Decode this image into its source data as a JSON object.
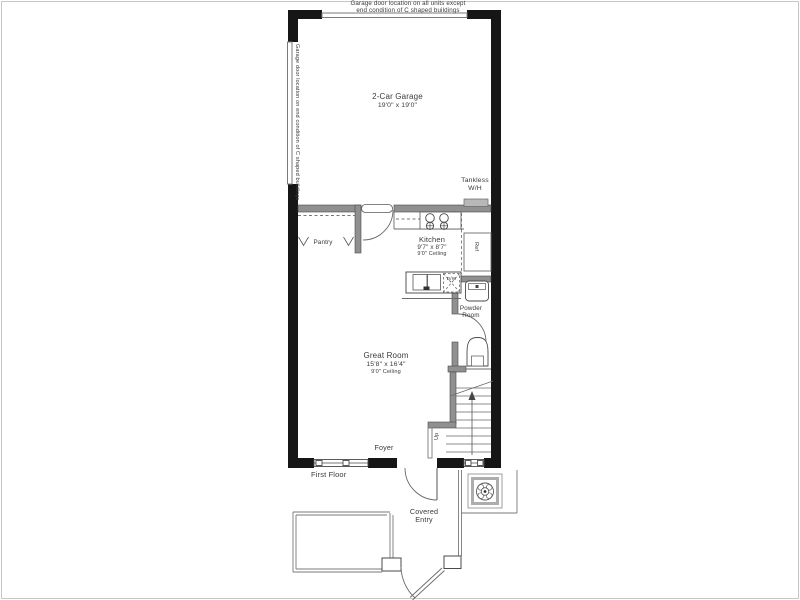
{
  "notes": {
    "top_line1": "Garage door location on all units except",
    "top_line2": "end condition of C shaped buildings",
    "side": "Garage door location on end condition of C shaped buildings"
  },
  "rooms": {
    "garage": {
      "name": "2-Car Garage",
      "dims": "19'0\" x 19'0\""
    },
    "kitchen": {
      "name": "Kitchen",
      "dims": "9'7\" x 8'7\"",
      "ceiling": "9'0\" Ceiling"
    },
    "great_room": {
      "name": "Great Room",
      "dims": "15'8\" x 16'4\"",
      "ceiling": "9'0\" Ceiling"
    },
    "powder_room": {
      "line1": "Powder",
      "line2": "Room"
    },
    "pantry": {
      "name": "Pantry"
    },
    "foyer": {
      "name": "Foyer"
    },
    "covered_entry": {
      "line1": "Covered",
      "line2": "Entry"
    }
  },
  "labels": {
    "first_floor": "First Floor",
    "tankless_line1": "Tankless",
    "tankless_line2": "W/H",
    "ref": "Ref",
    "dishwasher": "D/W",
    "up": "Up"
  },
  "colors": {
    "exterior_wall": "#161616",
    "interior_wall": "#909090",
    "line": "#6a6a6a",
    "text": "#3a3a3a"
  }
}
